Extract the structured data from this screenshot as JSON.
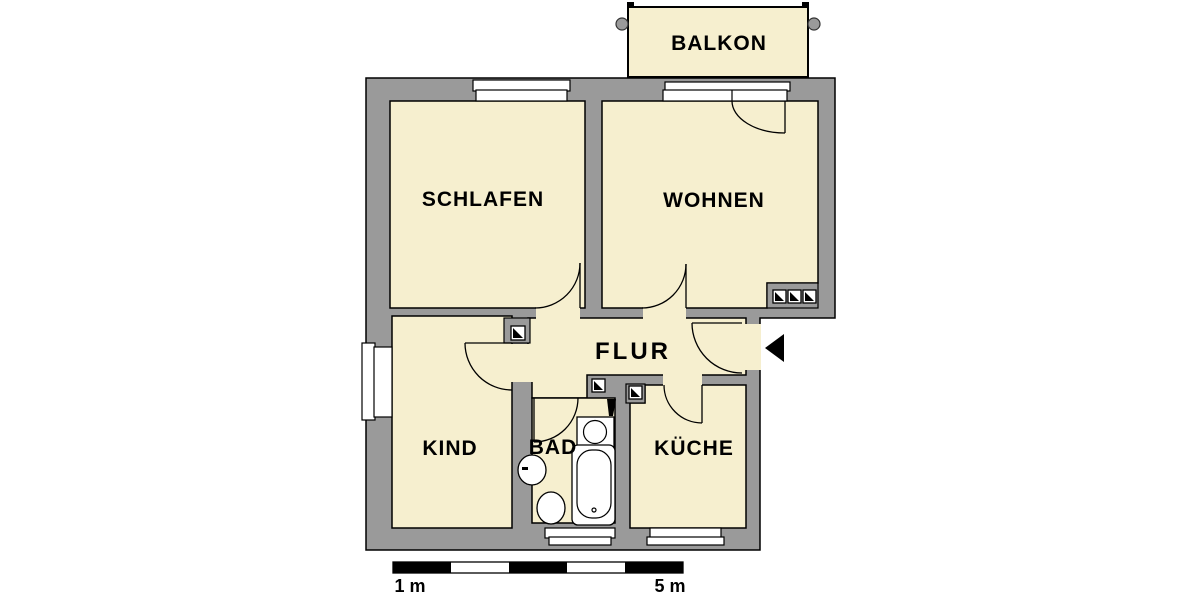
{
  "floorplan": {
    "rooms": {
      "balkon": {
        "label": "BALKON"
      },
      "schlafen": {
        "label": "SCHLAFEN"
      },
      "wohnen": {
        "label": "WOHNEN"
      },
      "flur": {
        "label": "FLUR"
      },
      "kind": {
        "label": "KIND"
      },
      "bad": {
        "label": "BAD"
      },
      "kueche": {
        "label": "KÜCHE"
      }
    },
    "scale_bar": {
      "start_label": "1 m",
      "end_label": "5 m",
      "segments": 5
    },
    "colors": {
      "room_fill": "#F6EFCF",
      "wall": "#9A9A9A",
      "outline": "#000000",
      "background": "#FFFFFF",
      "fixture_fill": "#FFFFFF"
    },
    "icons": {
      "entrance_arrow": "black triangle pointing left at apartment entry",
      "shaft_marker": "small square with black diagonal triangle (installation shaft)",
      "fixtures": [
        "bathtub",
        "washbasin",
        "toilet",
        "washing-machine"
      ]
    }
  }
}
